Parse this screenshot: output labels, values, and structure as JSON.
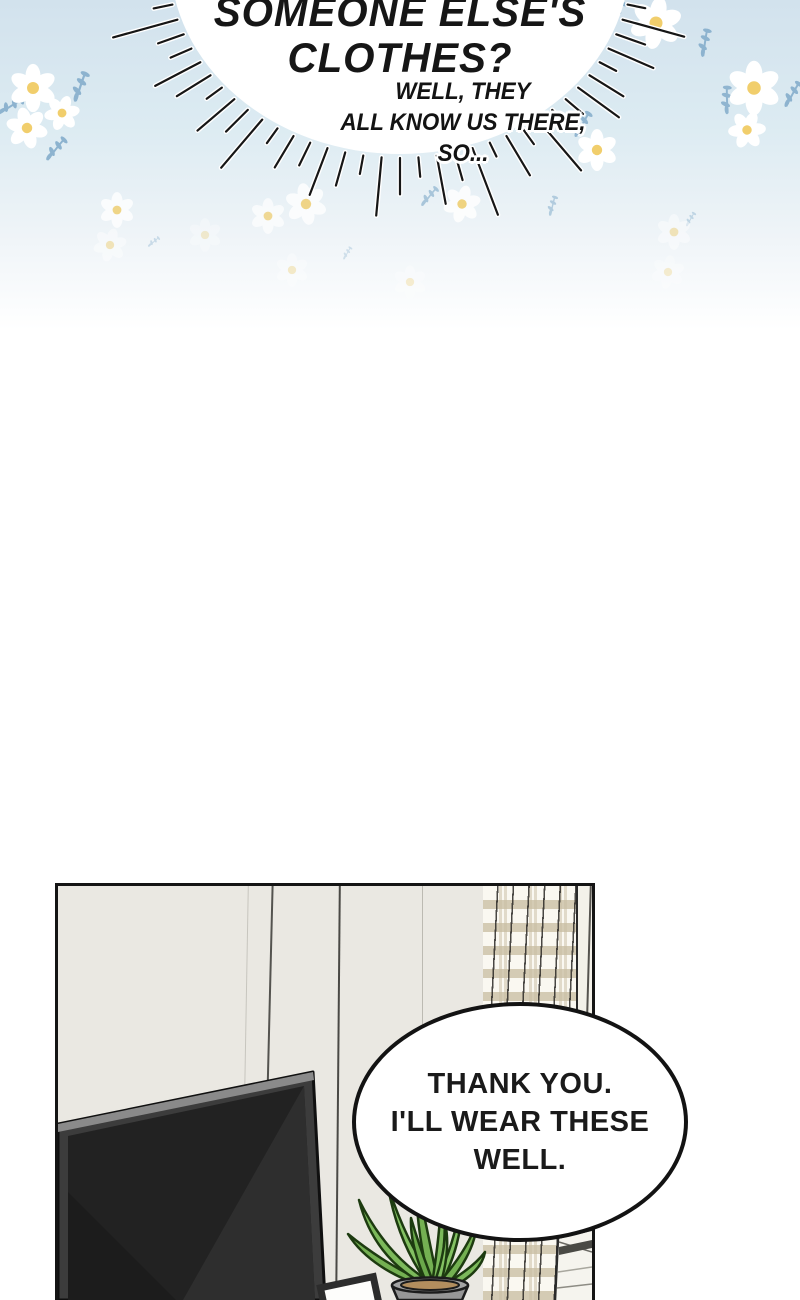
{
  "burst_bubble": {
    "line1": "SOMEONE ELSE'S",
    "line2": "CLOTHES?"
  },
  "caption": {
    "line1": "WELL, THEY",
    "line2": "ALL KNOW US THERE,",
    "line3": "SO..."
  },
  "speech_bubble": {
    "line1": "THANK YOU.",
    "line2": "I'LL WEAR THESE",
    "line3": "WELL."
  },
  "colors": {
    "sky_top": "#d2e2ed",
    "ink": "#141414",
    "wall": "#eae8e2",
    "curtain_base": "#faf8f1",
    "curtain_band": "#cbc0a5",
    "daisy_petal": "#ffffff",
    "daisy_center": "#f1ce6c",
    "sprig": "#8db3cf",
    "tv_frame": "#3c3c3c",
    "tv_screen": "#222222",
    "leaf": "#7cb95b",
    "leaf_outline": "#1d3b10",
    "pot": "#969696",
    "soil": "#b28e5e"
  },
  "decor": {
    "daisies": [
      {
        "x": 33,
        "y": 88,
        "s": 1.15,
        "o": 1,
        "r": 0
      },
      {
        "x": 62,
        "y": 113,
        "s": 0.85,
        "o": 1,
        "r": 20
      },
      {
        "x": 27,
        "y": 128,
        "s": 1.0,
        "o": 1,
        "r": -15
      },
      {
        "x": 656,
        "y": 23,
        "s": 1.25,
        "o": 1,
        "r": 10
      },
      {
        "x": 754,
        "y": 88,
        "s": 1.3,
        "o": 1,
        "r": 0
      },
      {
        "x": 747,
        "y": 130,
        "s": 0.9,
        "o": 1,
        "r": 25
      },
      {
        "x": 597,
        "y": 150,
        "s": 1.0,
        "o": 1,
        "r": 0
      },
      {
        "x": 117,
        "y": 210,
        "s": 0.85,
        "o": 0.8,
        "r": 0
      },
      {
        "x": 110,
        "y": 245,
        "s": 0.8,
        "o": 0.45,
        "r": 15
      },
      {
        "x": 268,
        "y": 216,
        "s": 0.85,
        "o": 0.7,
        "r": 0
      },
      {
        "x": 306,
        "y": 204,
        "s": 1.0,
        "o": 0.8,
        "r": -10
      },
      {
        "x": 292,
        "y": 270,
        "s": 0.8,
        "o": 0.35,
        "r": 0
      },
      {
        "x": 462,
        "y": 204,
        "s": 0.9,
        "o": 0.85,
        "r": 15
      },
      {
        "x": 674,
        "y": 232,
        "s": 0.85,
        "o": 0.45,
        "r": 0
      },
      {
        "x": 668,
        "y": 272,
        "s": 0.8,
        "o": 0.3,
        "r": 10
      },
      {
        "x": 410,
        "y": 282,
        "s": 0.8,
        "o": 0.3,
        "r": 0
      },
      {
        "x": 205,
        "y": 235,
        "s": 0.8,
        "o": 0.3,
        "r": 0
      }
    ],
    "sprigs": [
      {
        "x": 75,
        "y": 85,
        "s": 1,
        "o": 1,
        "r": -10
      },
      {
        "x": 8,
        "y": 102,
        "s": 0.9,
        "o": 1,
        "r": 30
      },
      {
        "x": 52,
        "y": 146,
        "s": 0.9,
        "o": 1,
        "r": 10
      },
      {
        "x": 610,
        "y": 12,
        "s": 1,
        "o": 1,
        "r": 0
      },
      {
        "x": 700,
        "y": 42,
        "s": 0.9,
        "o": 1,
        "r": -20
      },
      {
        "x": 788,
        "y": 92,
        "s": 0.9,
        "o": 1,
        "r": 0
      },
      {
        "x": 722,
        "y": 100,
        "s": 0.9,
        "o": 0.95,
        "r": -30
      },
      {
        "x": 578,
        "y": 122,
        "s": 0.9,
        "o": 0.95,
        "r": 0
      },
      {
        "x": 426,
        "y": 194,
        "s": 0.75,
        "o": 0.7,
        "r": 10
      },
      {
        "x": 549,
        "y": 205,
        "s": 0.65,
        "o": 0.6,
        "r": -15
      },
      {
        "x": 688,
        "y": 218,
        "s": 0.5,
        "o": 0.45,
        "r": 0
      },
      {
        "x": 152,
        "y": 240,
        "s": 0.45,
        "o": 0.4,
        "r": 20
      },
      {
        "x": 345,
        "y": 252,
        "s": 0.45,
        "o": 0.35,
        "r": 0
      }
    ]
  }
}
